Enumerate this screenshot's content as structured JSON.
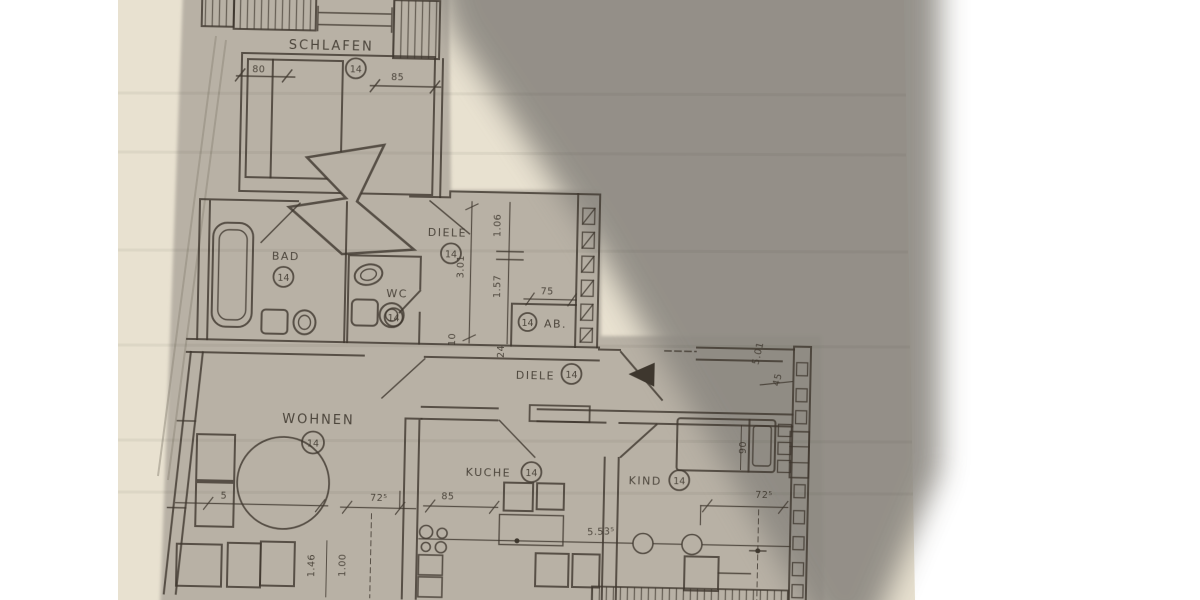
{
  "photo": {
    "colors": {
      "background": "#ffffff",
      "paper": "#e8e1d0",
      "photocopy": "#b8b1a5",
      "shadow": "#8d8982",
      "ink": "#3e372e"
    }
  },
  "floor_plan": {
    "rooms": {
      "schlafen": {
        "label": "SCHLAFEN",
        "badge": "14"
      },
      "bad": {
        "label": "BAD",
        "badge": "14"
      },
      "wc": {
        "label": "WC",
        "badge": "14"
      },
      "diele_upper": {
        "label": "DIELE",
        "badge": "14"
      },
      "ab": {
        "label": "AB.",
        "badge": "14"
      },
      "diele_lower": {
        "label": "DIELE",
        "badge": "14"
      },
      "wohnen": {
        "label": "WOHNEN",
        "badge": "14"
      },
      "kueche": {
        "label": "KUCHE",
        "badge": "14"
      },
      "kind": {
        "label": "KIND",
        "badge": "14"
      }
    },
    "dims": {
      "d80": "80",
      "d85": "85",
      "d301": "3.01",
      "d106": "1.06",
      "d157": "1.57",
      "d75": "75",
      "d10": "10",
      "d24": "24",
      "d501": "5.01",
      "d45": "45",
      "d5": "5",
      "d725_wohnen": "72⁵",
      "d146": "1.46",
      "d100": "1.00",
      "d85_kueche": "85",
      "d5535": "5.53⁵",
      "d90": "90",
      "d725_kind": "72⁵"
    }
  }
}
